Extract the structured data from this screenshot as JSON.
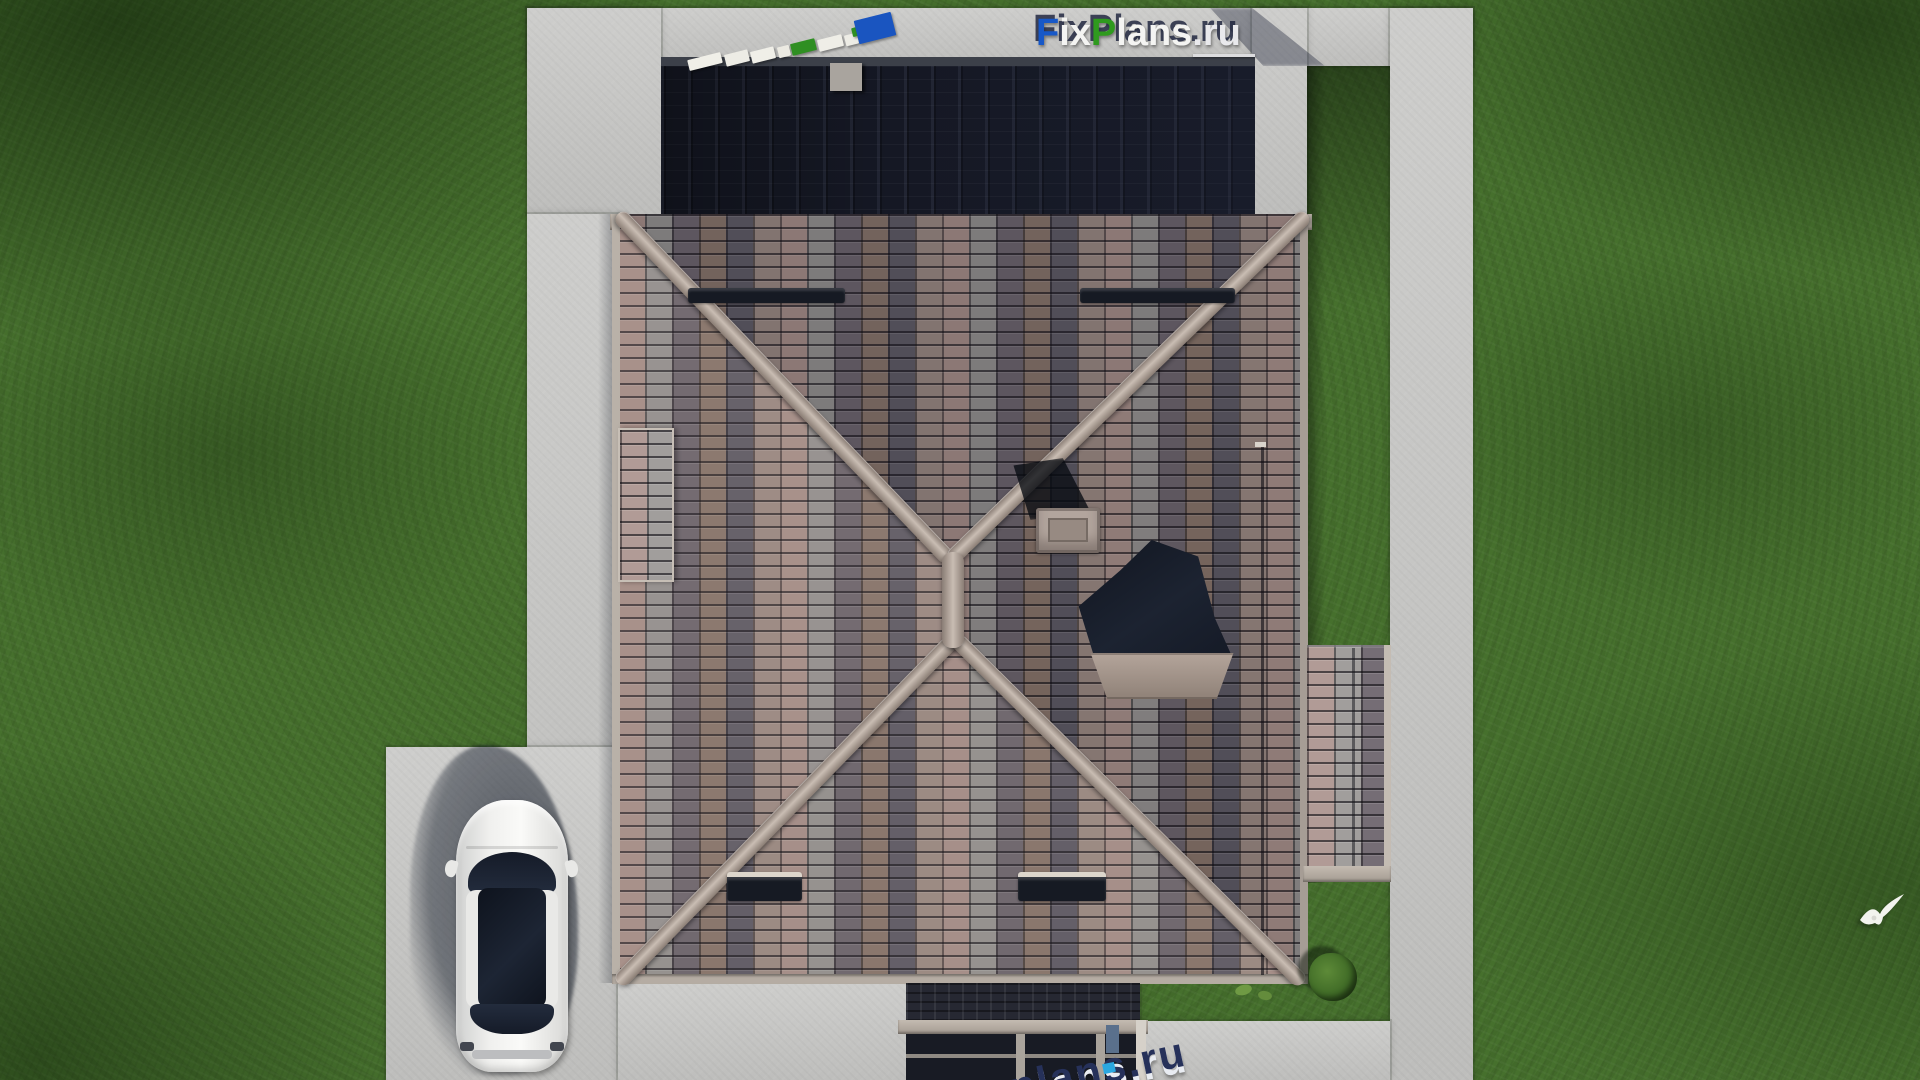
{
  "watermarks": {
    "logo": {
      "full_text": "FixPlans.ru",
      "segments": [
        {
          "text": "F",
          "color": "#1758c8"
        },
        {
          "text": "ix",
          "color": "#f4f4f2"
        },
        {
          "text": "P",
          "color": "#2f9a1e"
        },
        {
          "text": "lans",
          "color": "#f4f4f2"
        },
        {
          "text": ".ru",
          "color": "#e9e9ec"
        }
      ]
    },
    "bottom_partial": {
      "text": "plans.ru"
    },
    "top_tilted": {
      "description": "perspective-distorted watermark blocks",
      "block_colors": [
        "#f0efe8",
        "#2f8f22",
        "#1a55c0"
      ]
    }
  },
  "scene": {
    "view": "top-down aerial 3D render",
    "objects": [
      "hip-roof house",
      "dark shadowed back roof",
      "chimney",
      "skylight",
      "side extension roof",
      "entrance porch",
      "concrete walkways",
      "driveway",
      "white car",
      "lawn",
      "bush",
      "white bird"
    ]
  },
  "colors": {
    "grass": "#46702d",
    "grass-dark": "#2e5220",
    "concrete": "#c8c8c6",
    "tile-a": "#a18a84",
    "tile-b": "#908d8b",
    "tile-c": "#696169",
    "ridge": "#c9bdb3",
    "dark-roof": "#151824",
    "glass": "#1b2230",
    "car-body": "#f0f0ee",
    "accent-blue": "#1758c8",
    "accent-green": "#2f9a1e",
    "wm-white": "#f4f4f2",
    "wm-gray": "#e9e9ec",
    "wm-navy": "#26315a",
    "wm-cyan": "#2aa7e0"
  }
}
